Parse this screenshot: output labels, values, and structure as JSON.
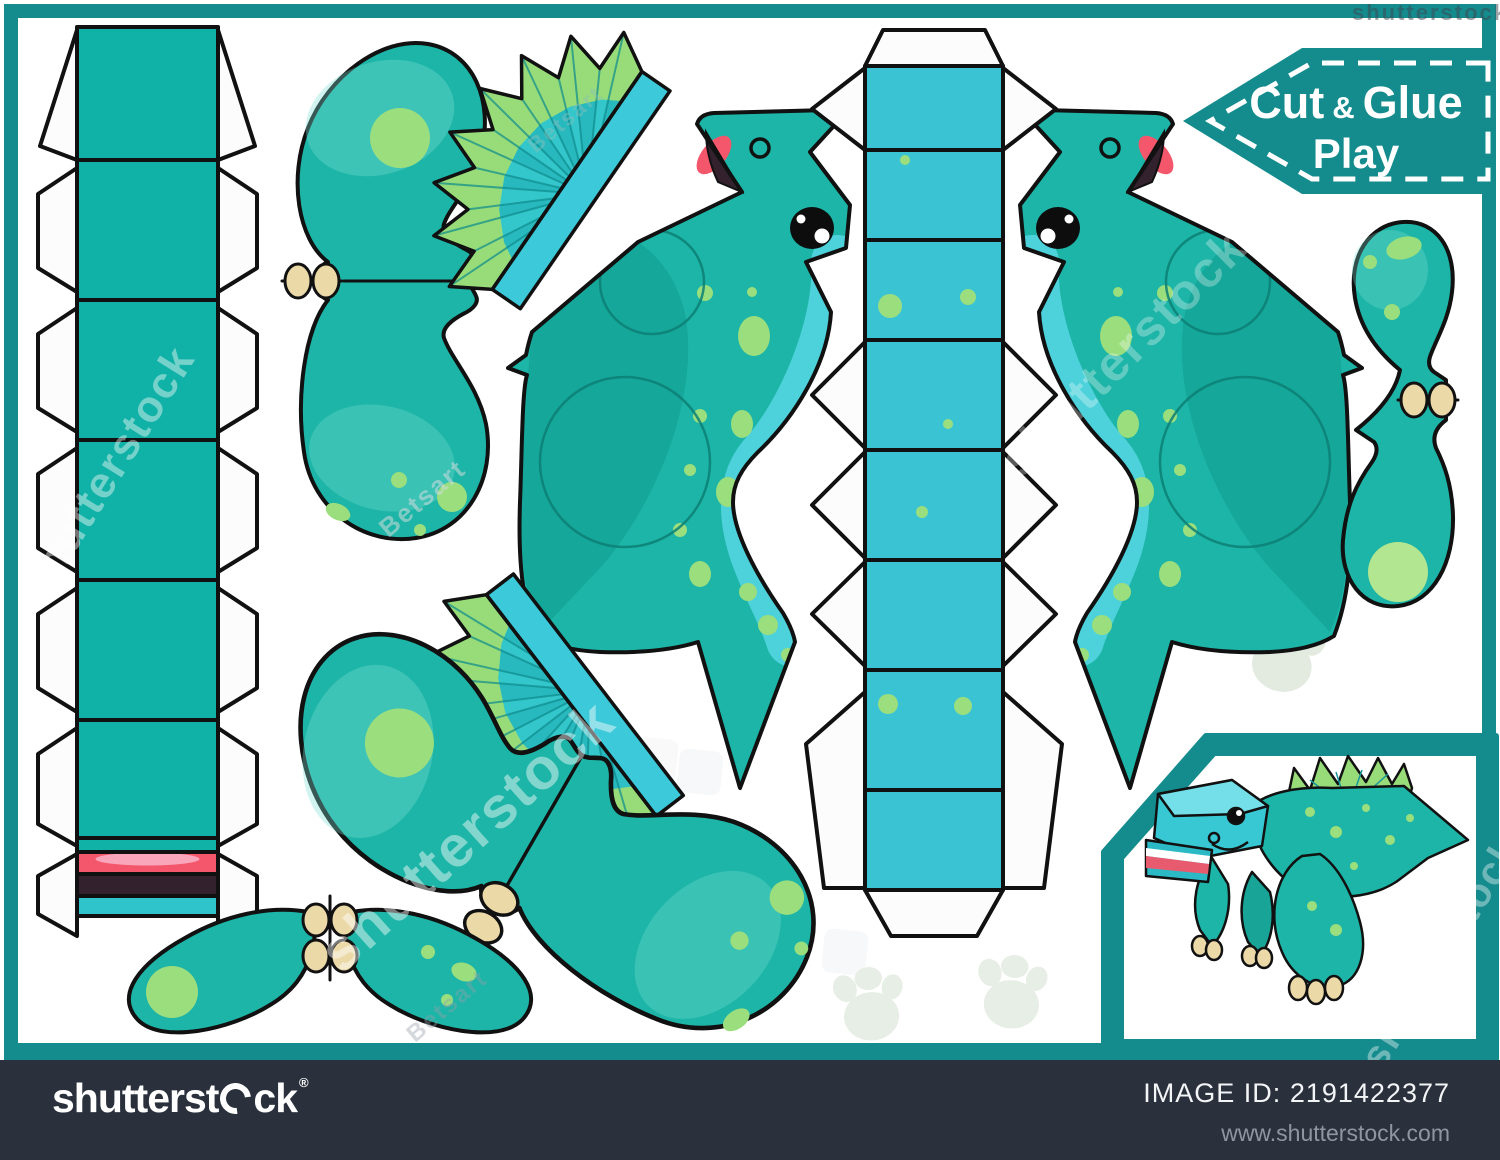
{
  "banner": {
    "cut": "Cut",
    "amp": "&",
    "glue": "Glue",
    "play": "Play"
  },
  "watermarks": {
    "brand": "shutterstock",
    "artist": "Betsart"
  },
  "footer": {
    "brand_prefix": "shutterst",
    "brand_suffix": "ck",
    "registered": "®",
    "image_id_label": "IMAGE ID:",
    "image_id": "2191422377",
    "website": "www.shutterstock.com"
  },
  "colors": {
    "frame_teal": "#148b8d",
    "strip_teal": "#10b1a6",
    "strip_cyan": "#2fc3cc",
    "center_strip_cyan": "#3ac4d3",
    "body_teal": "#1db5a7",
    "body_dark": "#0e968a",
    "belly_cyan": "#4dd1da",
    "spot_green": "#9bde7d",
    "fan_teal": "#2ec0c5",
    "fan_green": "#98dc7a",
    "fan_strip": "#3cc9d9",
    "claw_beige": "#ecd9a8",
    "mouth_red": "#f4566c",
    "tongue_pink": "#f9a6ba",
    "mouth_dark": "#33222e",
    "footer_navy": "#2a313d",
    "paw_pale": "#e7eee5"
  }
}
